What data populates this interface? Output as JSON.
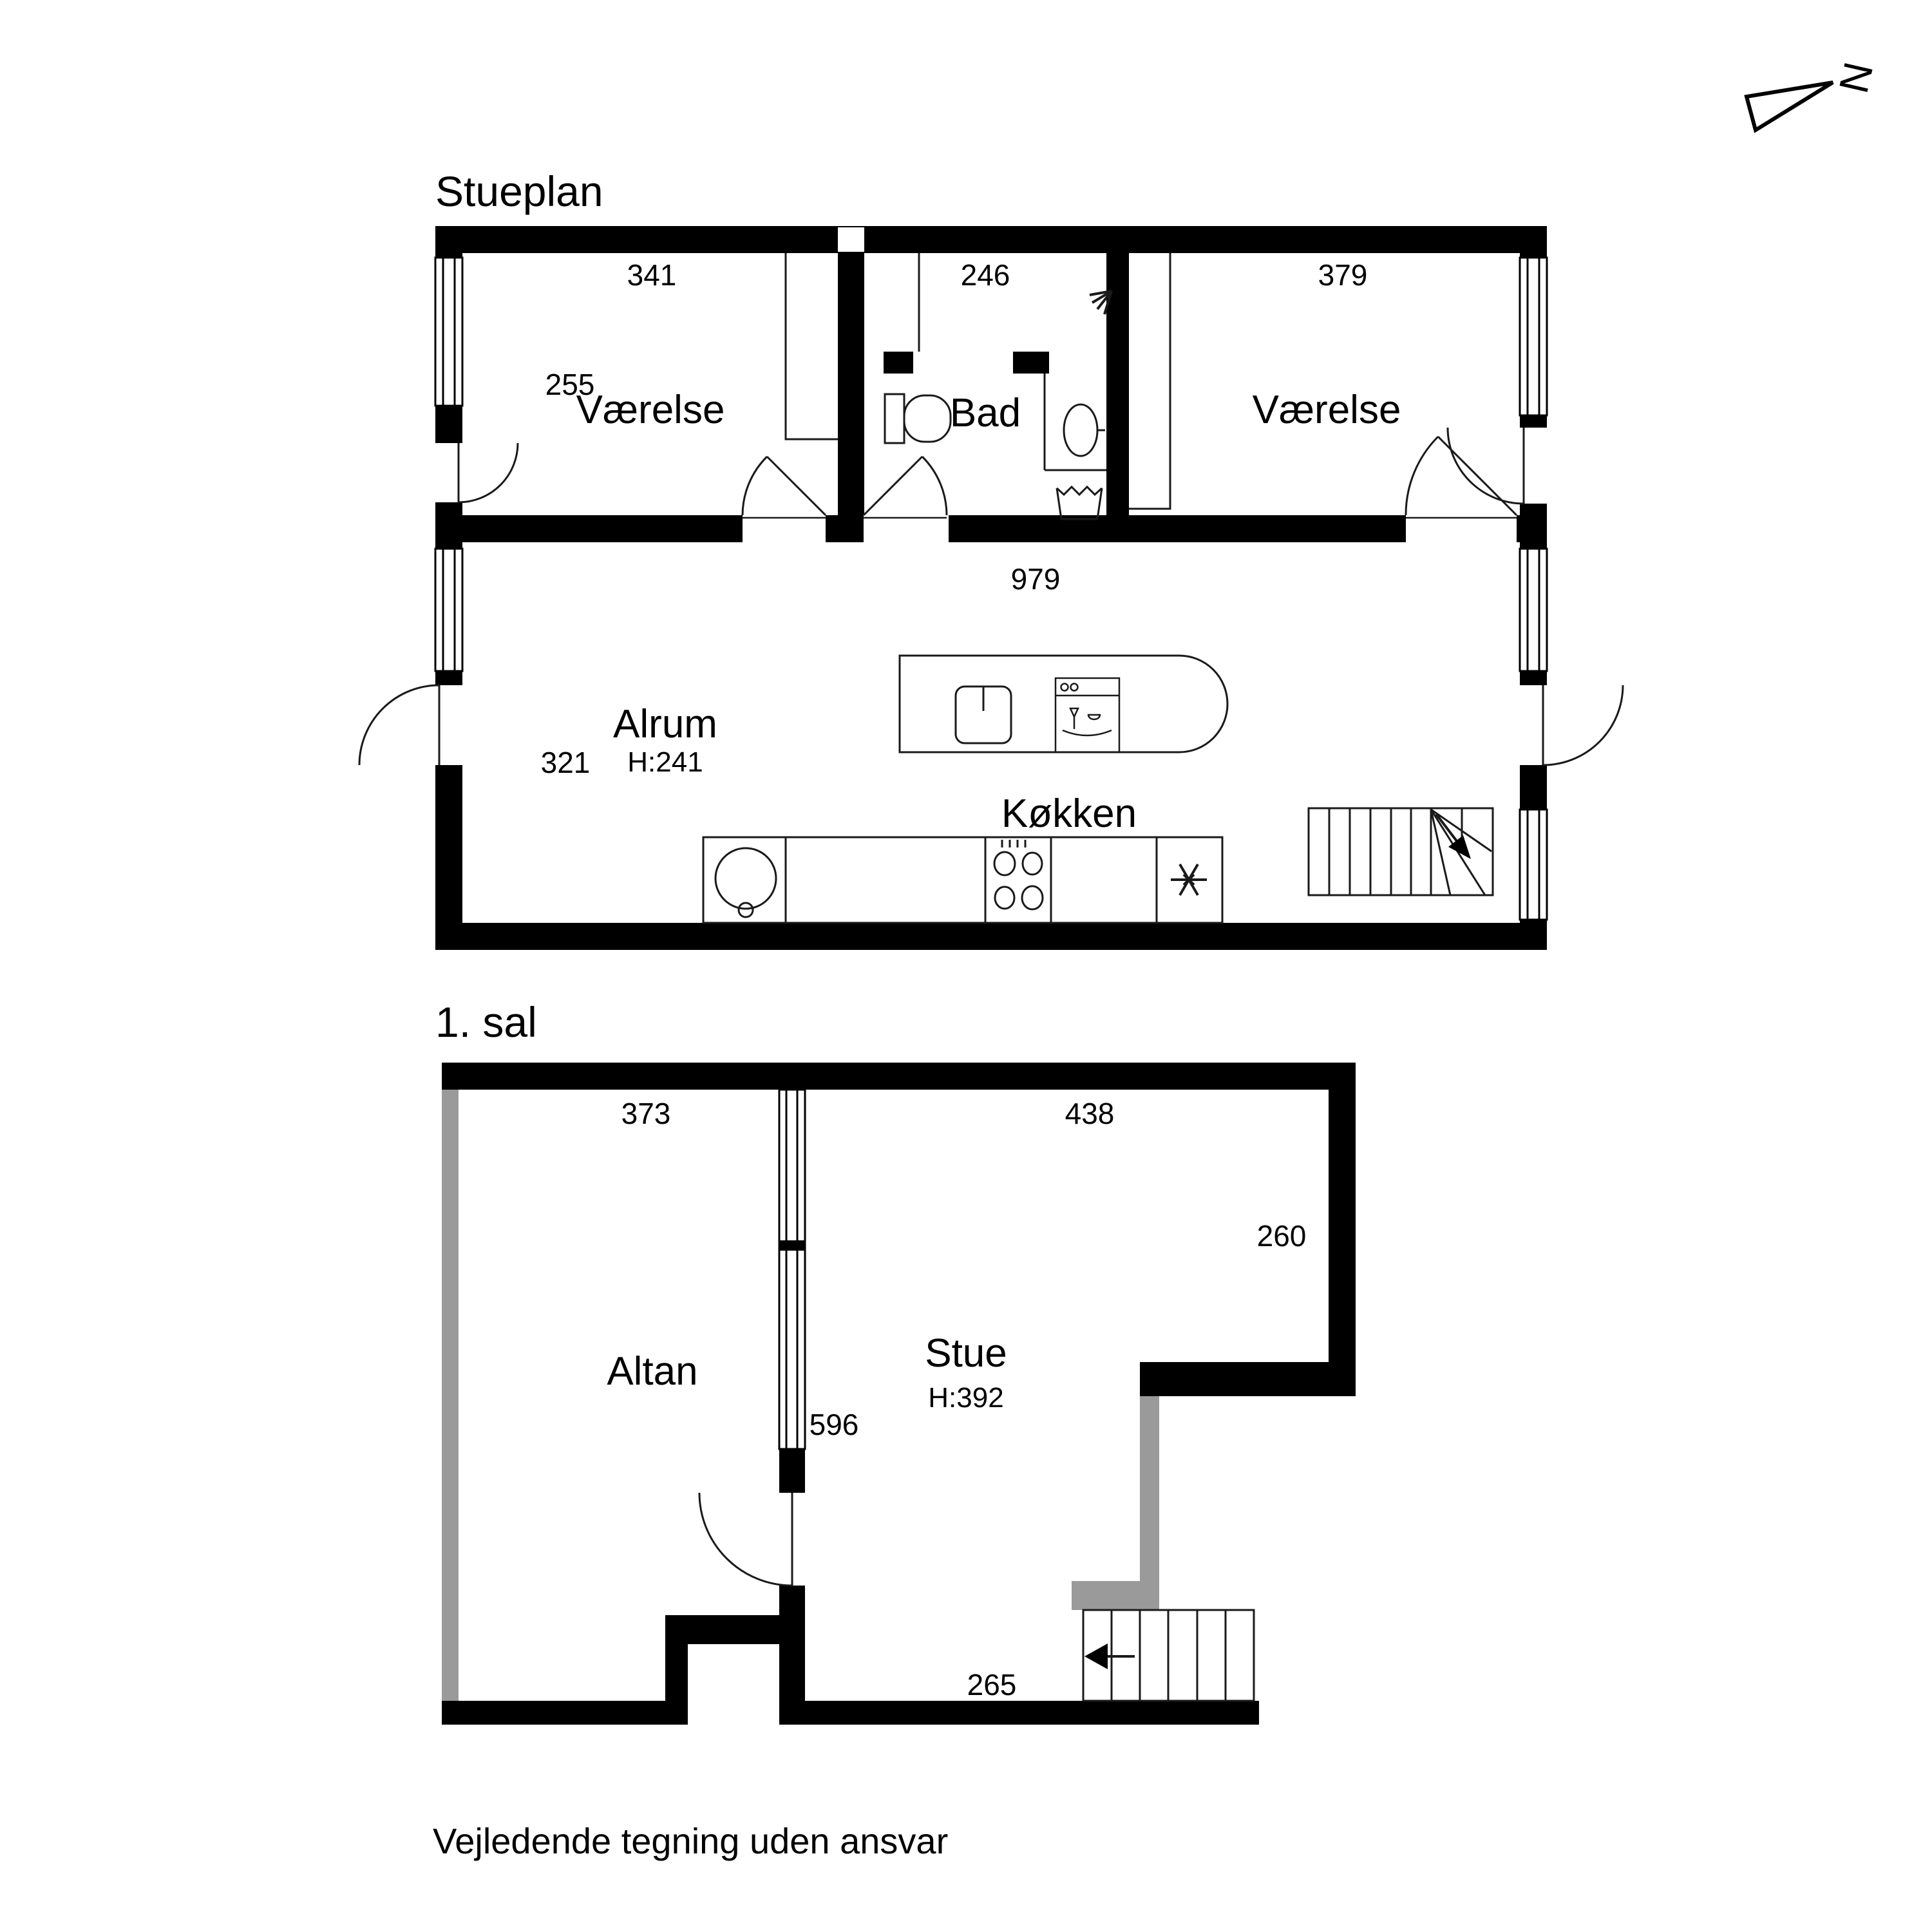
{
  "compass": {
    "label": "N"
  },
  "stueplan": {
    "title": "Stueplan",
    "rooms": {
      "vaerelse_left": "Værelse",
      "bad": "Bad",
      "vaerelse_right": "Værelse",
      "alrum": "Alrum",
      "alrum_ceiling": "H:241",
      "koekken": "Køkken"
    },
    "dims": {
      "vaerelse_left_width": "341",
      "bad_width": "246",
      "vaerelse_right_width": "379",
      "vaerelse_left_depth": "255",
      "alrum_window": "321",
      "total_width": "979"
    }
  },
  "first_floor": {
    "title": "1. sal",
    "rooms": {
      "altan": "Altan",
      "stue": "Stue",
      "stue_ceiling": "H:392"
    },
    "dims": {
      "altan_width": "373",
      "stue_width": "438",
      "stue_right": "260",
      "partition": "596",
      "stue_bottom": "265"
    }
  },
  "footer": {
    "disclaimer": "Vejledende tegning uden ansvar"
  },
  "colors": {
    "ink": "#000000",
    "railing": "#9a9a9a",
    "background": "#ffffff"
  }
}
